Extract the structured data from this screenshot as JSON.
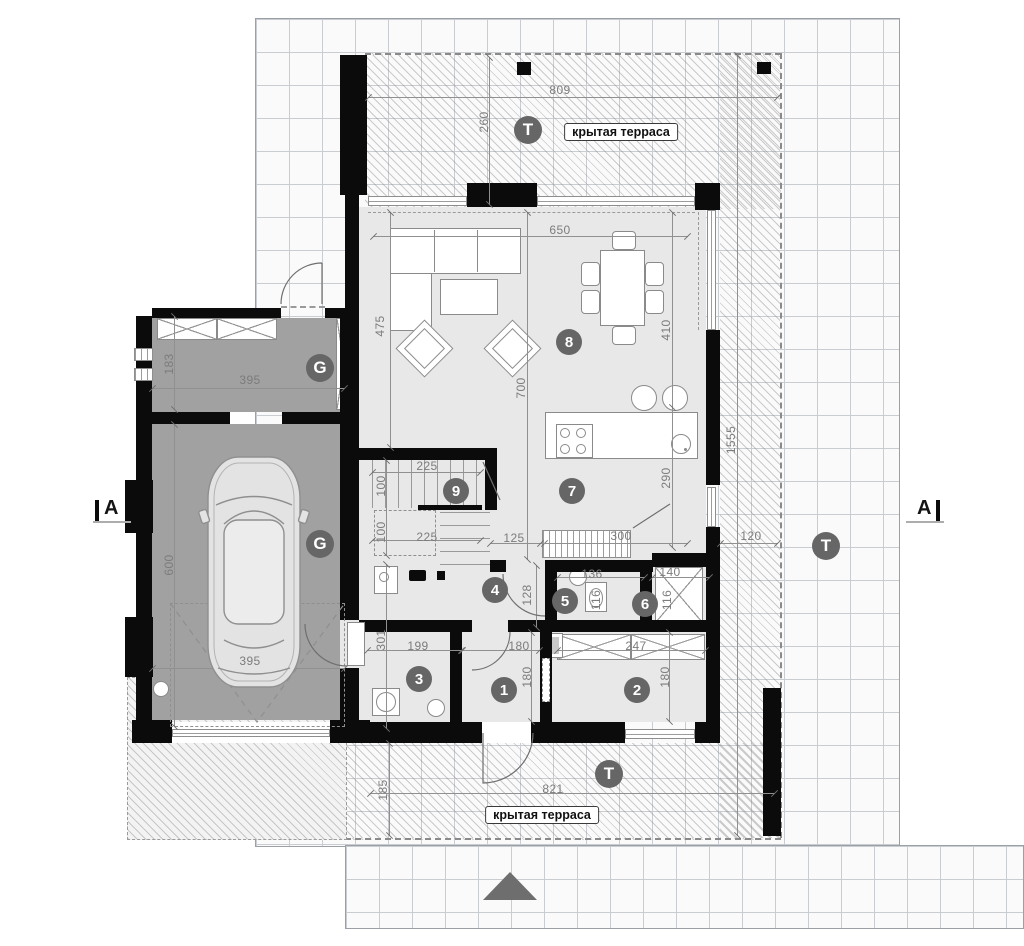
{
  "title": "floor-plan-ground-level",
  "colors": {
    "wall": "#0b0b0b",
    "floor": "#e8e8e8",
    "garage_floor": "#a1a1a1",
    "marker_circle": "#666666",
    "dimension_text": "#7c7c7c",
    "grid_line": "#c9ccd0",
    "north_arrow": "#6e6e6e"
  },
  "section_markers": {
    "left": "A",
    "right": "A"
  },
  "terrace_labels": [
    {
      "text": "крытая терраса",
      "x": 621,
      "y": 132
    },
    {
      "text": "крытая терраса",
      "x": 542,
      "y": 815
    }
  ],
  "compass": {
    "type": "north-triangle",
    "x": 483,
    "y": 872
  },
  "zone_markers": [
    {
      "label": "T",
      "x": 528,
      "y": 130
    },
    {
      "label": "T",
      "x": 826,
      "y": 546
    },
    {
      "label": "T",
      "x": 609,
      "y": 774
    },
    {
      "label": "G",
      "x": 320,
      "y": 368
    },
    {
      "label": "G",
      "x": 320,
      "y": 544
    }
  ],
  "room_markers": [
    {
      "label": "1",
      "x": 504,
      "y": 690
    },
    {
      "label": "2",
      "x": 637,
      "y": 690
    },
    {
      "label": "3",
      "x": 419,
      "y": 679
    },
    {
      "label": "4",
      "x": 495,
      "y": 590
    },
    {
      "label": "5",
      "x": 565,
      "y": 601
    },
    {
      "label": "6",
      "x": 645,
      "y": 604
    },
    {
      "label": "7",
      "x": 572,
      "y": 491
    },
    {
      "label": "8",
      "x": 569,
      "y": 342
    },
    {
      "label": "9",
      "x": 456,
      "y": 491
    }
  ],
  "dimensions": [
    {
      "text": "809",
      "o": "h",
      "x": 560,
      "y": 90
    },
    {
      "text": "260",
      "o": "v",
      "x": 484,
      "y": 122
    },
    {
      "text": "650",
      "o": "h",
      "x": 560,
      "y": 230
    },
    {
      "text": "475",
      "o": "v",
      "x": 380,
      "y": 326
    },
    {
      "text": "700",
      "o": "v",
      "x": 521,
      "y": 388
    },
    {
      "text": "410",
      "o": "v",
      "x": 666,
      "y": 330
    },
    {
      "text": "290",
      "o": "v",
      "x": 666,
      "y": 478
    },
    {
      "text": "1555",
      "o": "v",
      "x": 731,
      "y": 440
    },
    {
      "text": "300",
      "o": "h",
      "x": 621,
      "y": 536
    },
    {
      "text": "120",
      "o": "h",
      "x": 751,
      "y": 536
    },
    {
      "text": "125",
      "o": "h",
      "x": 514,
      "y": 538
    },
    {
      "text": "225",
      "o": "h",
      "x": 427,
      "y": 466
    },
    {
      "text": "100",
      "o": "v",
      "x": 381,
      "y": 486
    },
    {
      "text": "100",
      "o": "v",
      "x": 381,
      "y": 532
    },
    {
      "text": "225",
      "o": "h",
      "x": 427,
      "y": 537
    },
    {
      "text": "183",
      "o": "v",
      "x": 169,
      "y": 364
    },
    {
      "text": "395",
      "o": "h",
      "x": 250,
      "y": 380
    },
    {
      "text": "600",
      "o": "v",
      "x": 169,
      "y": 565
    },
    {
      "text": "395",
      "o": "h",
      "x": 250,
      "y": 661
    },
    {
      "text": "301",
      "o": "v",
      "x": 381,
      "y": 640
    },
    {
      "text": "199",
      "o": "h",
      "x": 418,
      "y": 646
    },
    {
      "text": "180",
      "o": "h",
      "x": 519,
      "y": 646
    },
    {
      "text": "180",
      "o": "v",
      "x": 527,
      "y": 677
    },
    {
      "text": "247",
      "o": "h",
      "x": 636,
      "y": 646
    },
    {
      "text": "180",
      "o": "v",
      "x": 665,
      "y": 677
    },
    {
      "text": "136",
      "o": "h",
      "x": 592,
      "y": 574
    },
    {
      "text": "116",
      "o": "v",
      "x": 596,
      "y": 600
    },
    {
      "text": "140",
      "o": "h",
      "x": 670,
      "y": 572
    },
    {
      "text": "116",
      "o": "v",
      "x": 667,
      "y": 600
    },
    {
      "text": "128",
      "o": "v",
      "x": 527,
      "y": 595
    },
    {
      "text": "185",
      "o": "v",
      "x": 383,
      "y": 790
    },
    {
      "text": "821",
      "o": "h",
      "x": 553,
      "y": 789
    }
  ]
}
